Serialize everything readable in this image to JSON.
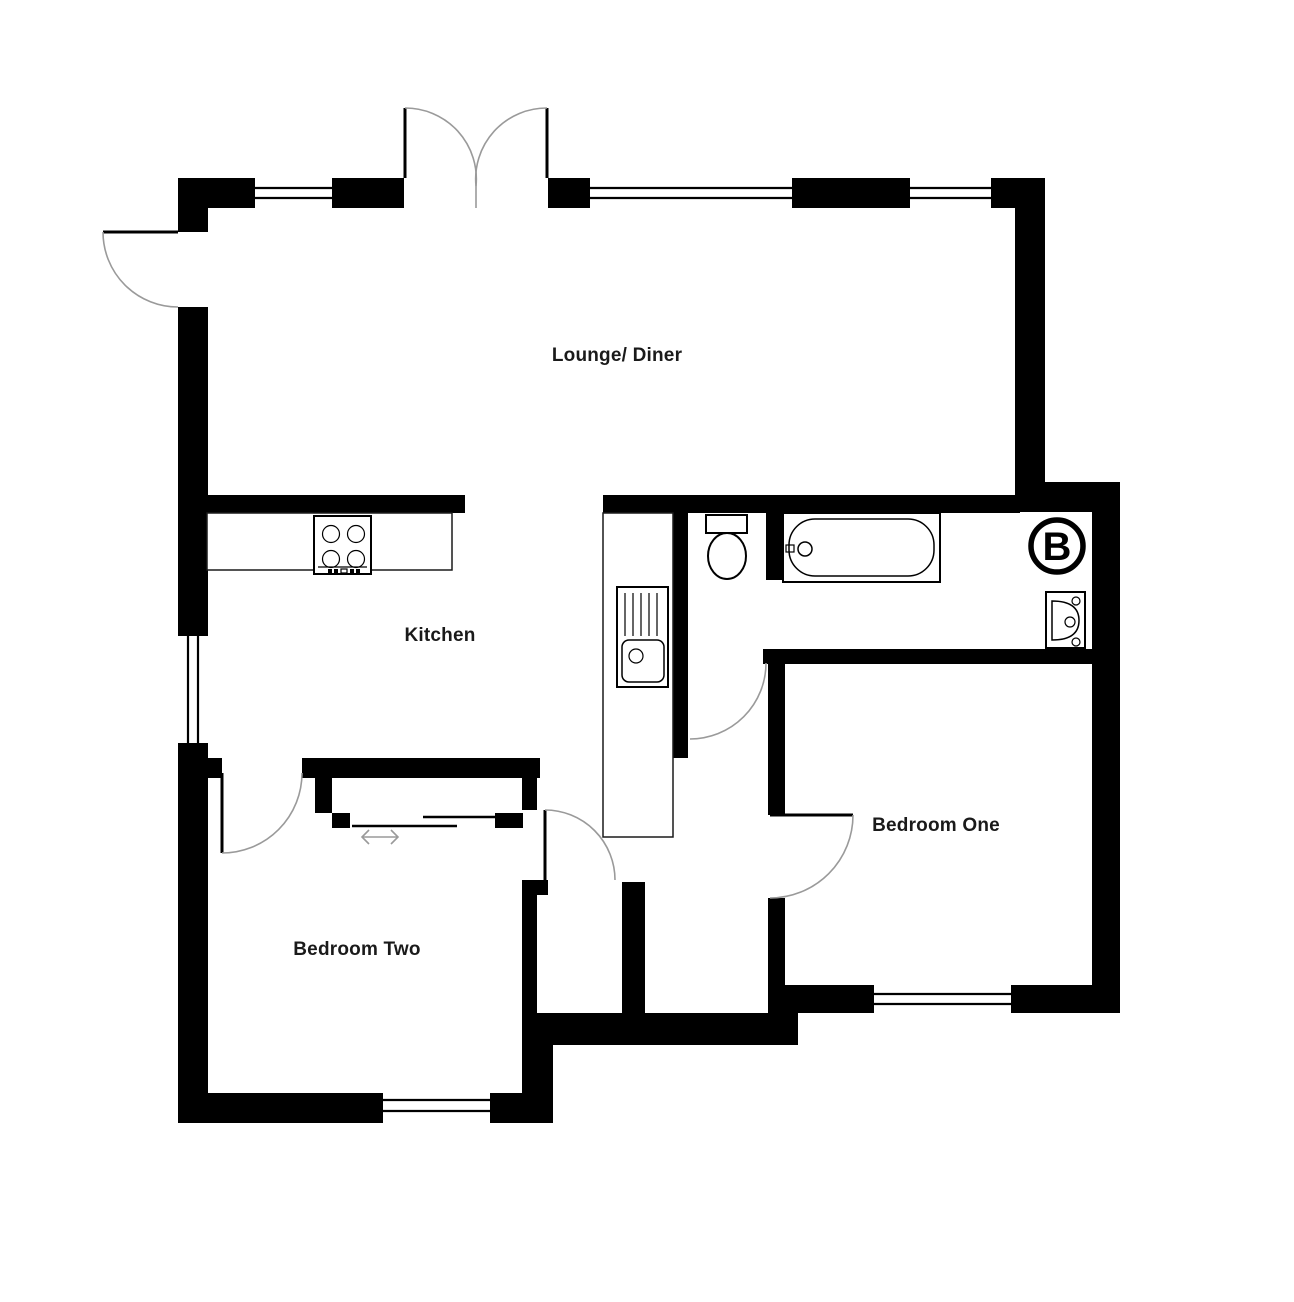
{
  "floorplan": {
    "rooms": [
      {
        "id": "lounge-diner",
        "label": "Lounge/ Diner"
      },
      {
        "id": "kitchen",
        "label": "Kitchen"
      },
      {
        "id": "bedroom-one",
        "label": "Bedroom One"
      },
      {
        "id": "bedroom-two",
        "label": "Bedroom Two"
      }
    ],
    "symbols": {
      "boiler": "B"
    },
    "fixtures": [
      "bath",
      "toilet",
      "wash-basin",
      "kitchen-sink-drainer",
      "hob",
      "worktop",
      "sliding-door-wardrobe",
      "boiler"
    ],
    "colors": {
      "wall": "#000000",
      "background": "#ffffff",
      "door_arc": "#9a9a9a",
      "fixture_outline": "#000000"
    }
  }
}
